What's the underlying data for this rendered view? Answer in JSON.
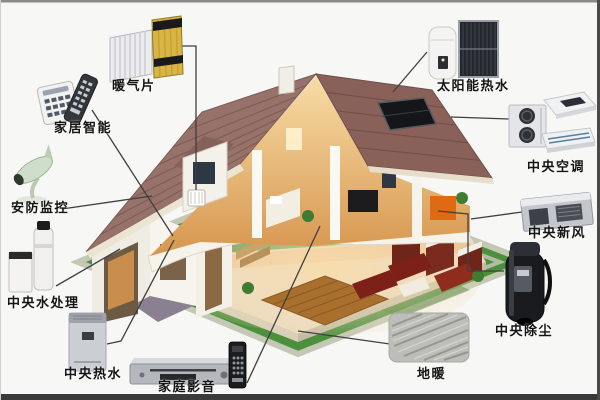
{
  "items": [
    {
      "id": "radiator",
      "label": "暖气片"
    },
    {
      "id": "smart-home-control",
      "label": "家居智能"
    },
    {
      "id": "security-monitoring",
      "label": "安防监控"
    },
    {
      "id": "central-water-treatment",
      "label": "中央水处理"
    },
    {
      "id": "central-hot-water",
      "label": "中央热水"
    },
    {
      "id": "home-av-system",
      "label": "家庭影音"
    },
    {
      "id": "floor-heating",
      "label": "地暖"
    },
    {
      "id": "central-vacuum",
      "label": "中央除尘"
    },
    {
      "id": "central-fresh-air",
      "label": "中央新风"
    },
    {
      "id": "central-air-conditioning",
      "label": "中央空调"
    },
    {
      "id": "solar-hot-water",
      "label": "太阳能热水"
    }
  ],
  "colors": {
    "background": "#f7f7f5",
    "lawn_green": "#4c8f3d",
    "roof_mauve": "#96726a",
    "label_text": "#141414",
    "leader_line": "#3f3f3f",
    "bottom_border": "#3a3a3a"
  }
}
